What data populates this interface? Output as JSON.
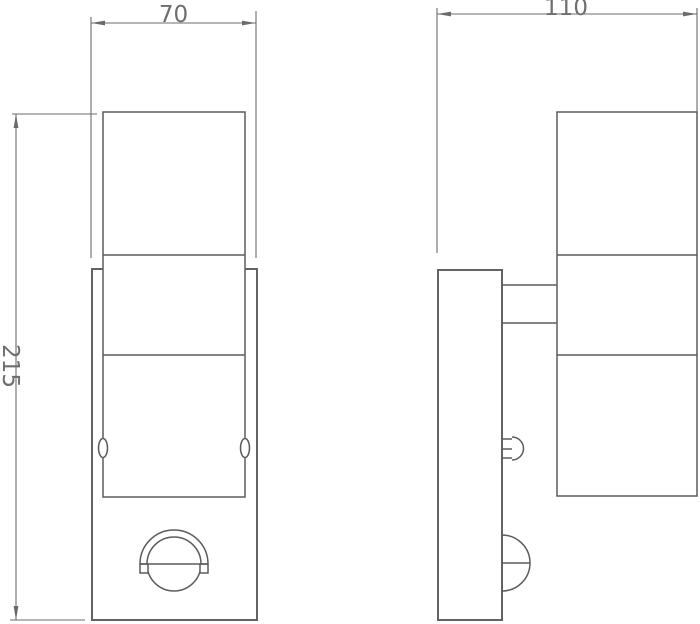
{
  "drawing": {
    "background_color": "#ffffff",
    "line_color": "#5c5c5c",
    "dimension_line_color": "#6b6b6b",
    "text_color": "#6e6e6e",
    "dimensions": {
      "front_width": "70",
      "side_depth": "110",
      "overall_height": "215"
    }
  }
}
